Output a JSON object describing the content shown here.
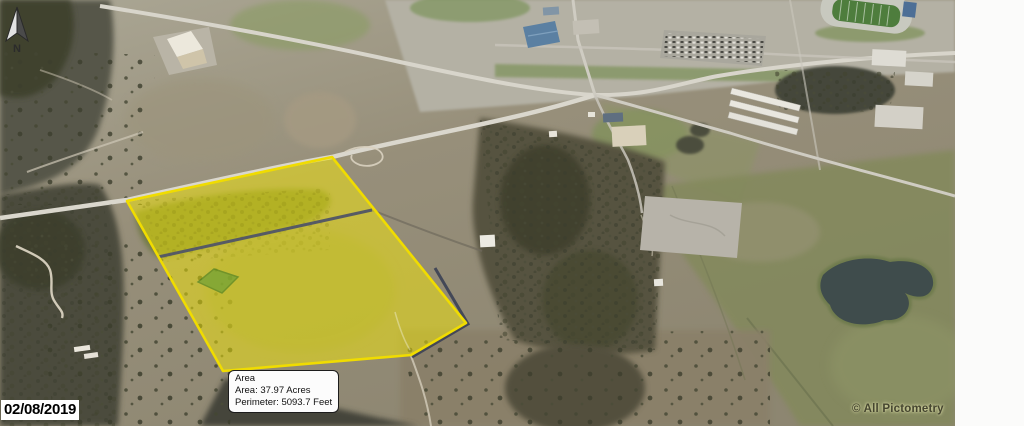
{
  "map": {
    "north_label": "N",
    "date_stamp": "02/08/2019",
    "copyright": "© All Pictometry"
  },
  "measurement_tooltip": {
    "title": "Area",
    "area_line": "Area: 37.97 Acres",
    "perimeter_line": "Perimeter: 5093.7 Feet"
  },
  "parcel": {
    "area_acres": "37.97",
    "perimeter_feet": "5093.7",
    "outline_color": "#f0dc00",
    "fill_color": "rgba(252,240,0,0.47)",
    "driveway_color": "#565a64",
    "green_zone_color": "#5f9c35"
  }
}
